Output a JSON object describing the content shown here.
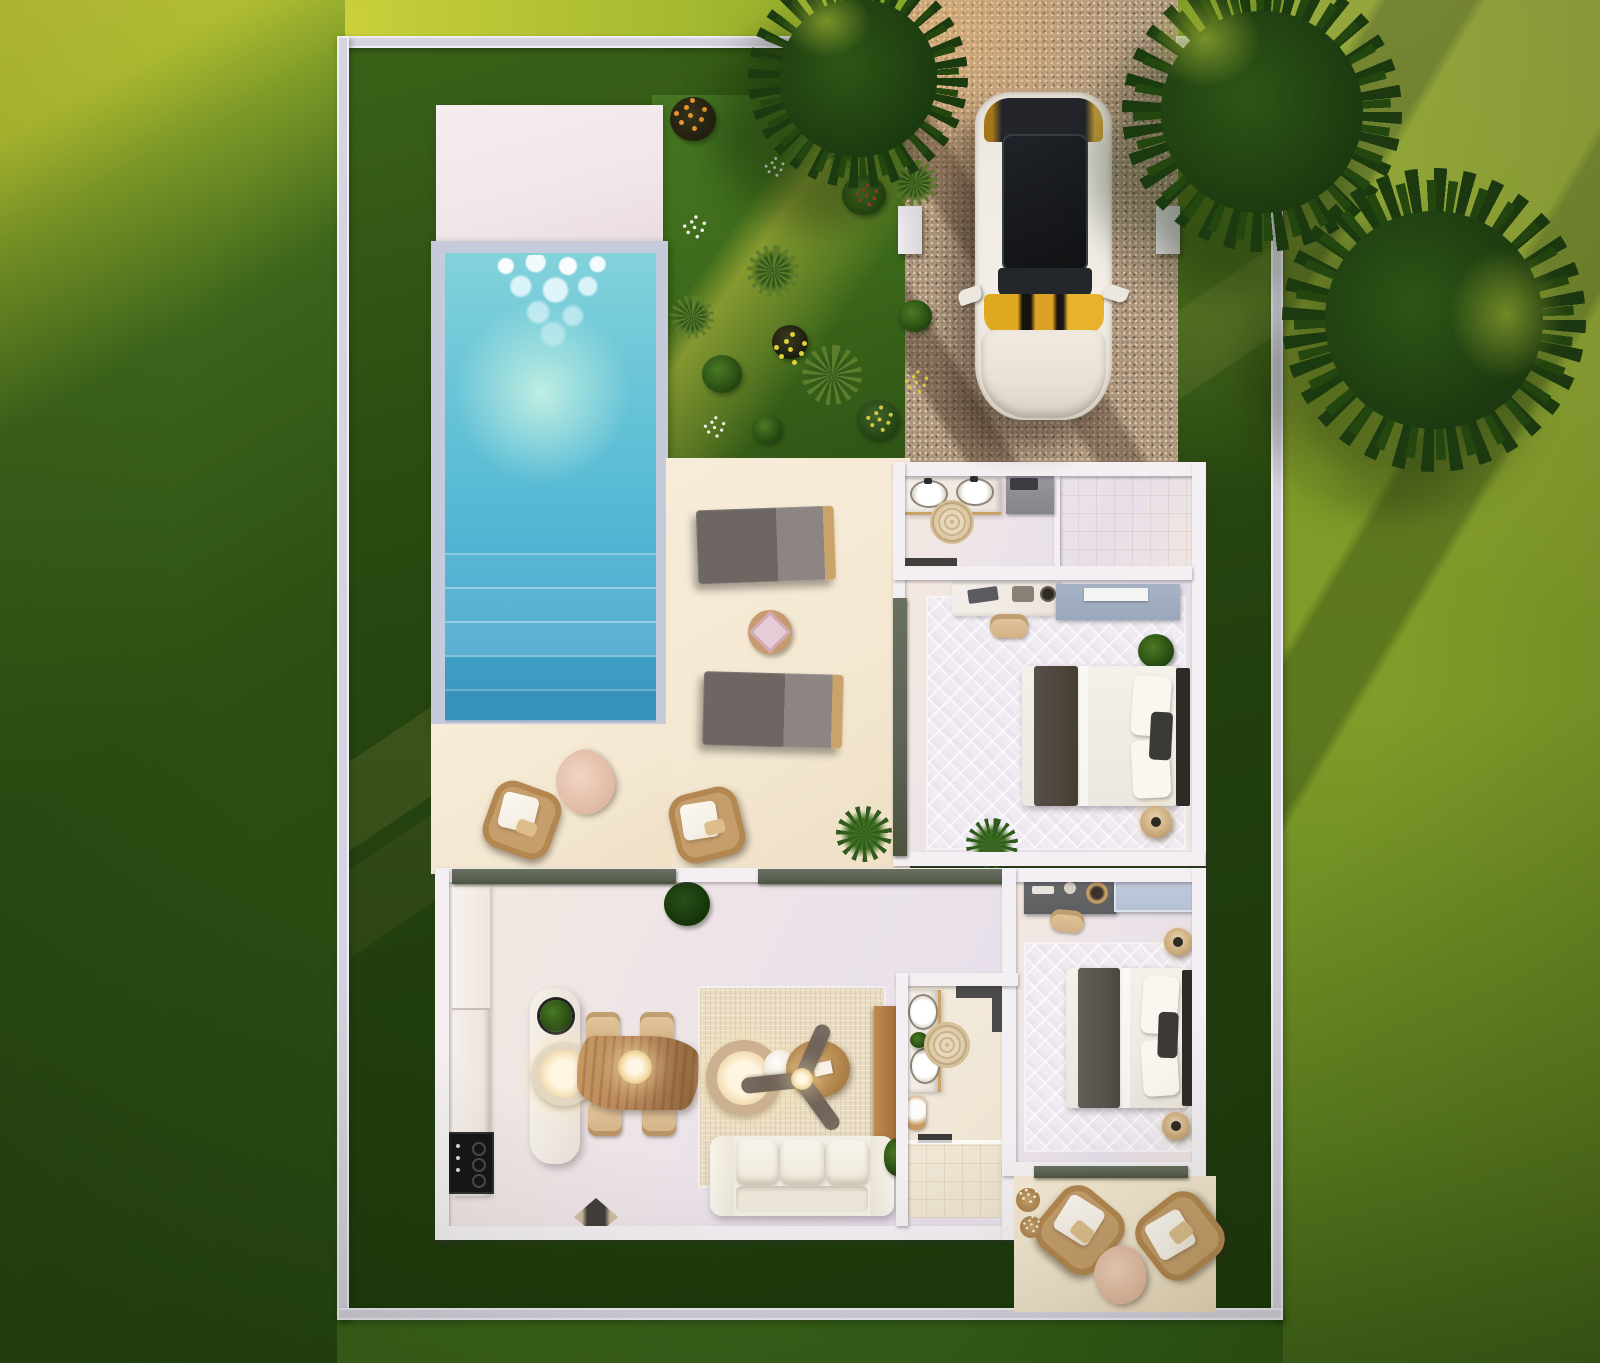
{
  "scene": {
    "kind": "architectural-render",
    "view": "top-down-floor-plan",
    "property": "villa with pool, garden, driveway and two patios",
    "visible_text": null
  },
  "colors": {
    "lawn-sunlit": "#c9d03b",
    "lawn-left-dark": "#2c4f13",
    "lawn-right": "#7d9727",
    "lawn-right-dark": "#416518",
    "property-grass": "#223f0e",
    "garden-grass": "#3e6b1b",
    "wall": "#d6d3e0",
    "wall-bright": "#efedf5",
    "deck": "#f1e6e8",
    "terrace": "#f4e8d2",
    "patio": "#f0e3cb",
    "gravel": "#b29a82",
    "pool-coping": "#c5cbda",
    "water-top": "#82d2da",
    "water-mid": "#55b9d4",
    "water-deep": "#3f9fc6",
    "floor": "#ece3ea",
    "rug-light": "#f0ebf3",
    "rug-beige": "#e9dcc2",
    "wood": "#b8865a",
    "wood-dark": "#8d6238",
    "sofa": "#f3efe5",
    "lounger": "#6e6663",
    "lounger-light": "#8d8582",
    "track": "#5c6254",
    "shower": "#ecd9ae",
    "closet-blue": "#b6c1d6",
    "dresser-blue": "#9aa7bc",
    "dresser-gray": "#5c5e60",
    "blanket": "#4e463c",
    "blanket2": "#57544e",
    "headboard": "#2e2b27",
    "car-body": "#efece4",
    "car-glass": "#17191c",
    "car-amber": "#dda125",
    "tree-dark": "#1c3a10",
    "tree-mid": "#2e5616",
    "wicker": "#c59e6b",
    "wicker-dark": "#b3874f",
    "cushion": "#f6f1e7",
    "rattan": "#cbb190"
  },
  "inventory": {
    "outdoor": [
      "pool with waterfall and steps",
      "white pool deck",
      "flower garden",
      "gravel driveway",
      "white car",
      "3 trees",
      "2 sun loungers",
      "round side table",
      "2 wicker armchairs with blanket and pouf",
      "rear patio with 2 wicker chairs and pouf",
      "perimeter wall with gate posts"
    ],
    "rooms": [
      "bathroom with double vanity and walk-in shower",
      "bedroom with double bed, desk and dresser",
      "open kitchen with island and live-edge dining table",
      "living room with sofa, ceiling fan and coffee table",
      "second bathroom with double vanity, toilet and shower",
      "second bedroom with double bed, dresser and closet"
    ]
  }
}
